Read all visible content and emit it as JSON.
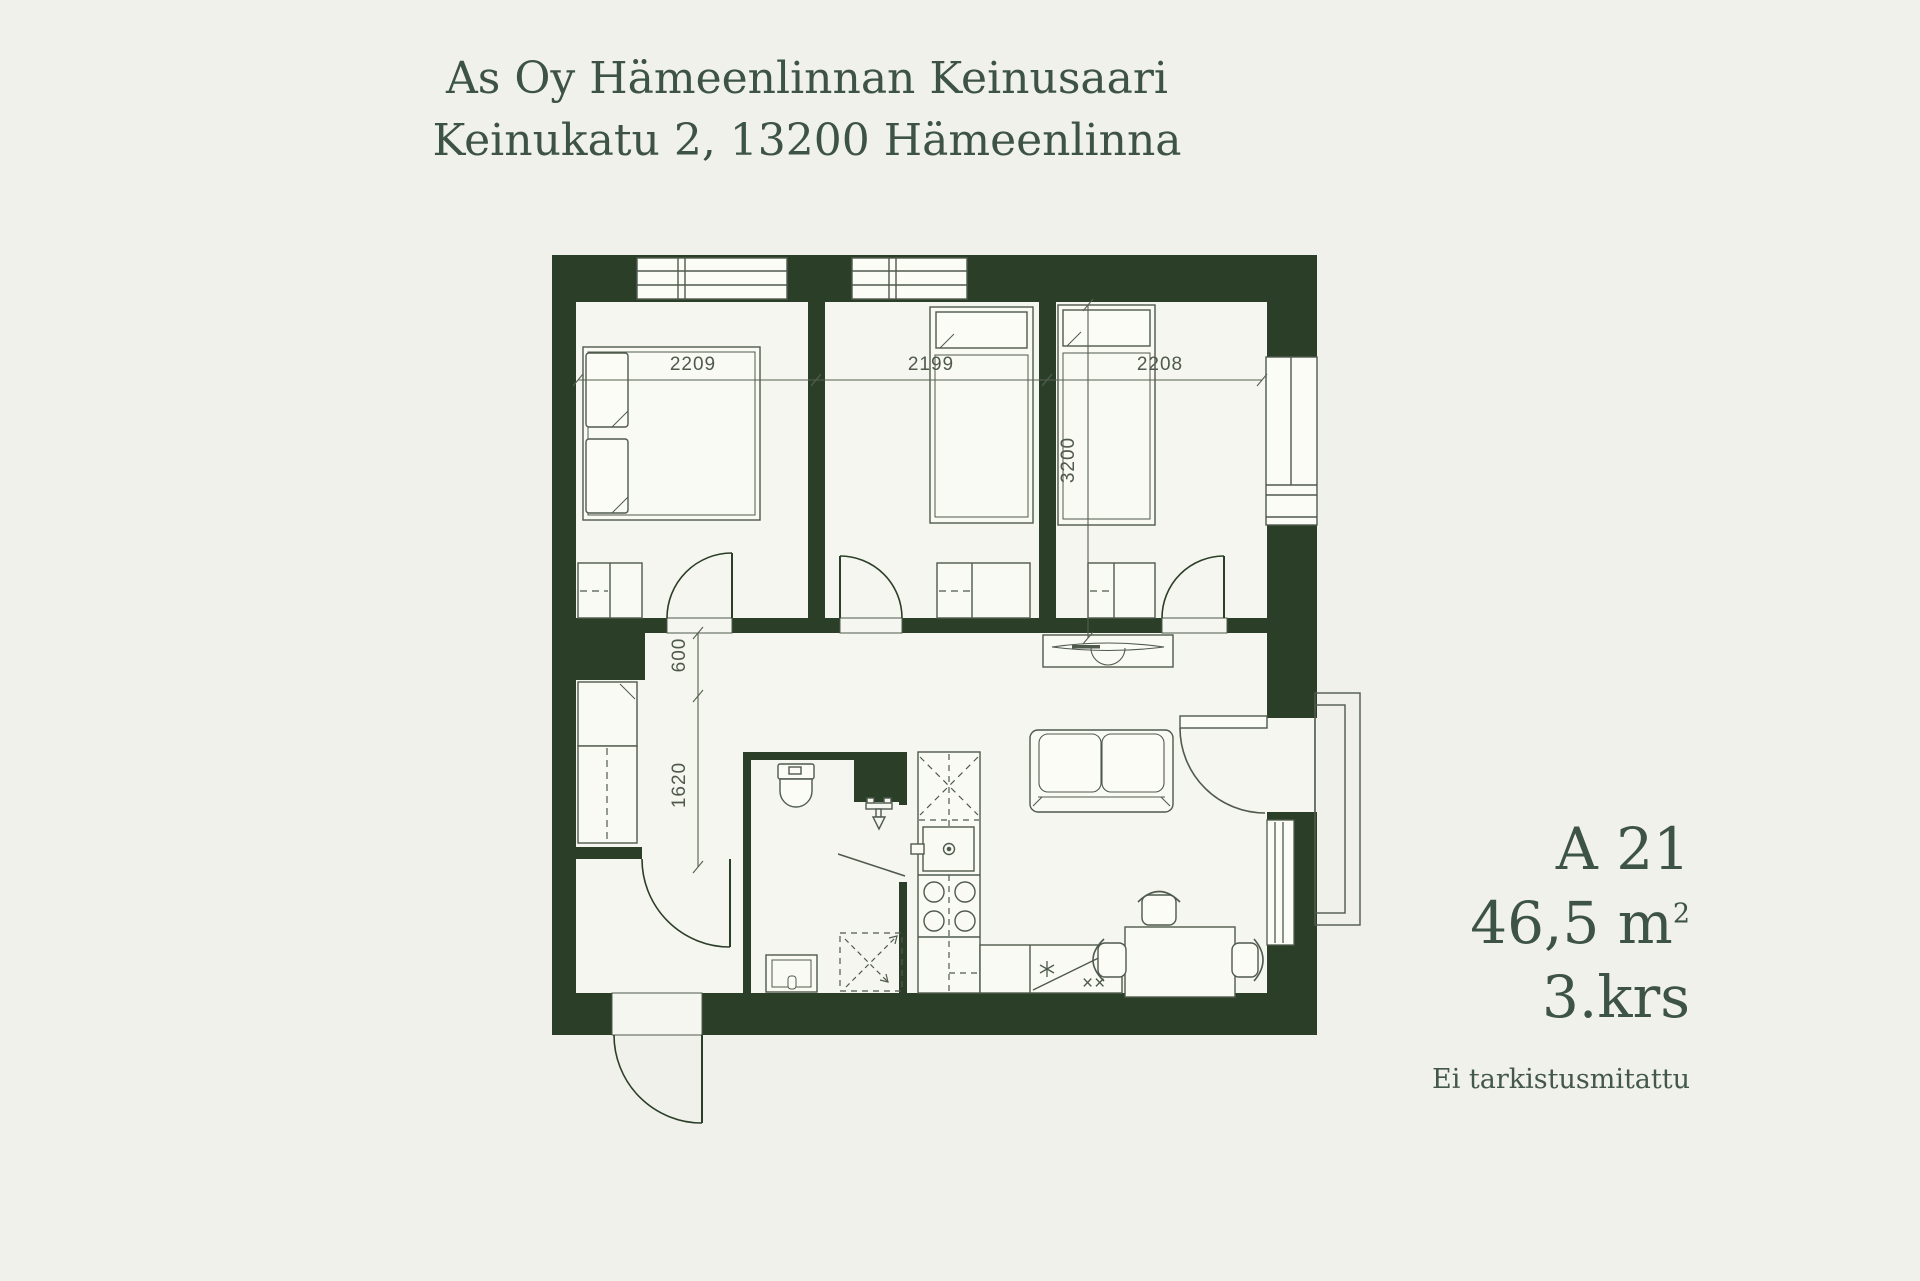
{
  "header": {
    "title_line1": "As Oy Hämeenlinnan Keinusaari",
    "title_line2": "Keinukatu 2, 13200 Hämeenlinna"
  },
  "apartment": {
    "unit": "A 21",
    "area_value": "46,5 m",
    "area_superscript": "2",
    "floor": "3.krs",
    "note": "Ei tarkistusmitattu"
  },
  "floor_plan": {
    "dimensions": {
      "bedroom1_width": "2209",
      "bedroom2_width": "2199",
      "bedroom3_width": "2208",
      "bedroom3_depth": "3200",
      "hall_niche": "600",
      "hall_closet_run": "1620"
    },
    "symbols": {
      "fridge_marks": "××"
    }
  },
  "colors": {
    "background": "#f1f1eb",
    "wall": "#2b3e27",
    "drawing_line": "#4f5a4d",
    "text": "#3d5345"
  }
}
